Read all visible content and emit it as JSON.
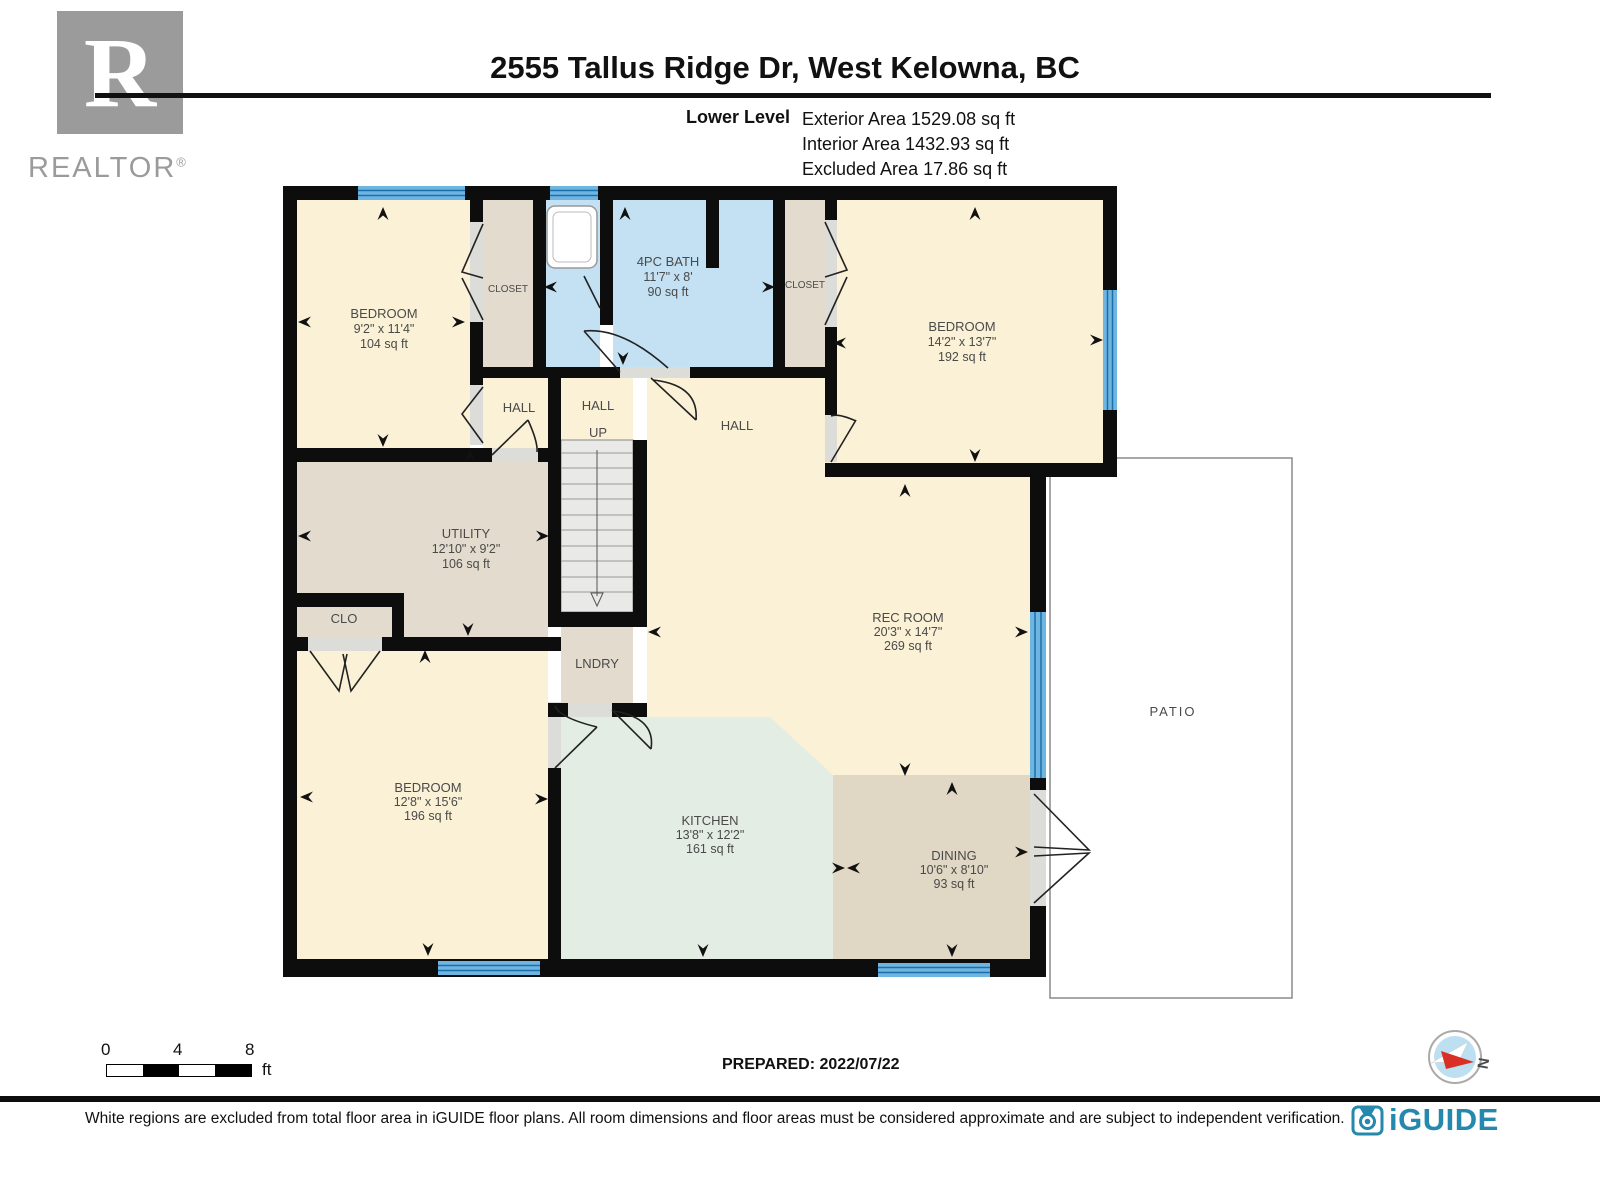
{
  "colors": {
    "wall": "#0d0d0d",
    "room_cream": "#FBF1D6",
    "room_beige": "#E3DCCE",
    "room_bath_blue": "#C3E1F3",
    "room_kitchen_mint": "#E4EDE3",
    "room_dining_tan": "#E0D7C4",
    "window_blue": "#6FB5E2",
    "window_stripe": "#1D6FA8",
    "brand_blue": "#2788AE",
    "compass_red": "#D93025",
    "realtor_gray": "#9B9B9B"
  },
  "header": {
    "title": "2555 Tallus Ridge Dr, West Kelowna, BC",
    "level_label": "Lower Level",
    "exterior_area": "Exterior Area 1529.08 sq ft",
    "interior_area": "Interior Area 1432.93 sq ft",
    "excluded_area": "Excluded Area 17.86 sq ft"
  },
  "branding": {
    "realtor_letter": "R",
    "realtor_label": "REALTOR",
    "registered_mark": "®",
    "iguide_label": "iGUIDE"
  },
  "rooms": {
    "bedroom_top_left": {
      "name": "BEDROOM",
      "dims": "9'2\" x 11'4\"",
      "area": "104 sq ft"
    },
    "closet_left": {
      "name": "CLOSET"
    },
    "bath": {
      "name": "4PC BATH",
      "dims": "11'7\" x 8'",
      "area": "90 sq ft"
    },
    "closet_right": {
      "name": "CLOSET"
    },
    "bedroom_top_right": {
      "name": "BEDROOM",
      "dims": "14'2\" x 13'7\"",
      "area": "192 sq ft"
    },
    "hall_west": {
      "name": "HALL"
    },
    "stair_hall": {
      "name": "HALL",
      "direction": "UP"
    },
    "hall_center": {
      "name": "HALL"
    },
    "utility": {
      "name": "UTILITY",
      "dims": "12'10\" x 9'2\"",
      "area": "106 sq ft"
    },
    "closet_small": {
      "name": "CLO"
    },
    "laundry": {
      "name": "LNDRY"
    },
    "rec_room": {
      "name": "REC ROOM",
      "dims": "20'3\" x 14'7\"",
      "area": "269 sq ft"
    },
    "bedroom_bottom_left": {
      "name": "BEDROOM",
      "dims": "12'8\" x 15'6\"",
      "area": "196 sq ft"
    },
    "kitchen": {
      "name": "KITCHEN",
      "dims": "13'8\" x 12'2\"",
      "area": "161 sq ft"
    },
    "dining": {
      "name": "DINING",
      "dims": "10'6\" x 8'10\"",
      "area": "93 sq ft"
    },
    "patio": {
      "name": "PATIO"
    }
  },
  "scale_bar": {
    "tick_start": "0",
    "tick_mid": "4",
    "tick_end": "8",
    "unit": "ft"
  },
  "footer": {
    "prepared": "PREPARED: 2022/07/22",
    "compass_north": "N",
    "disclaimer": "White regions are excluded from total floor area in iGUIDE floor plans. All room dimensions and floor areas must be considered approximate and are subject to independent verification."
  }
}
